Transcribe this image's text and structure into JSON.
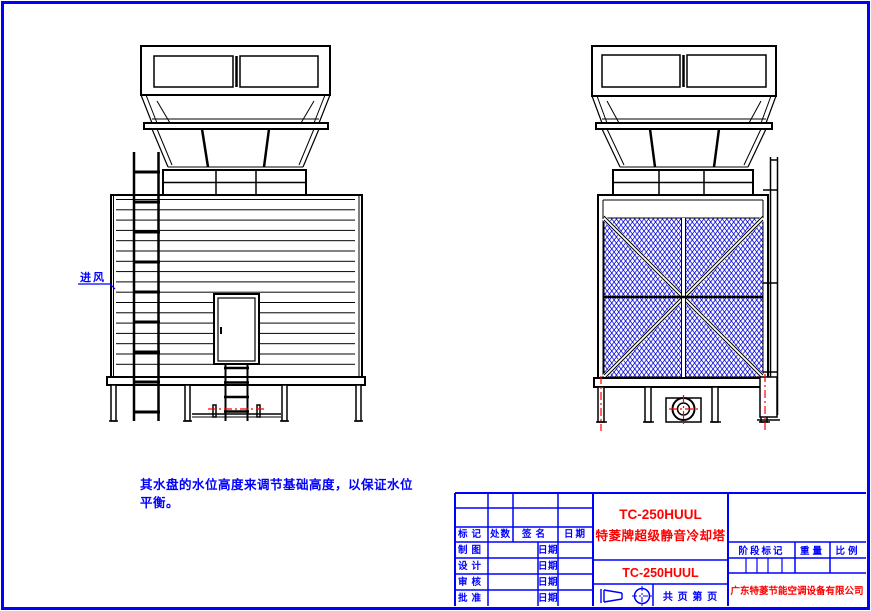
{
  "page": {
    "air_inlet_label": "进风",
    "note_line1": "其水盘的水位高度来调节基础高度，以保证水位",
    "note_line2": "平衡。"
  },
  "title_block": {
    "revision_headers": [
      "标记",
      "处数",
      "签名",
      "日期"
    ],
    "approval_rows": [
      {
        "role": "制图",
        "date_label": "日期"
      },
      {
        "role": "设计",
        "date_label": "日期"
      },
      {
        "role": "审核",
        "date_label": "日期"
      },
      {
        "role": "批准",
        "date_label": "日期"
      }
    ],
    "product_model": "TC-250HUUL",
    "product_name": "特菱牌超级静音冷却塔",
    "drawing_number": "TC-250HUUL",
    "stage_mark_header": "阶段标记",
    "weight_header": "重量",
    "scale_header": "比例",
    "page_label": "共 页 第 页",
    "company": "广东特菱节能空调设备有限公司"
  },
  "colors": {
    "border_blue": "#0000ff",
    "text_red": "#ff0000",
    "drawing_black": "#000000",
    "mesh_blue": "#0000dd",
    "centerline_red": "#ff0000"
  }
}
